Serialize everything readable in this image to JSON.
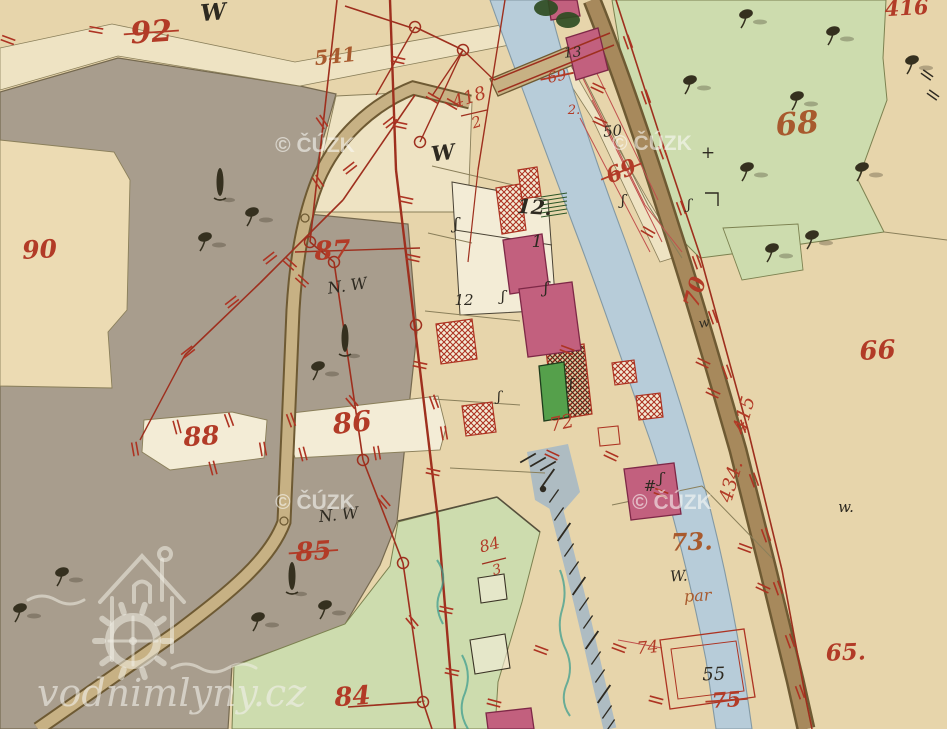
{
  "map_meta": {
    "kind": "historical-cadastral-map",
    "width": 947,
    "height": 729
  },
  "palette": {
    "paper": "#e7d5ab",
    "paper_light": "#eee3c3",
    "paper_white": "#f3ecd6",
    "pasture_gray": "#a89d8d",
    "pasture_edge": "#75694f",
    "meadow_green": "#cddcae",
    "meadow_edge": "#7c8150",
    "river_blue": "#b7ccd9",
    "river_edge": "#8399a4",
    "race_blue": "#aebcc2",
    "road_tan": "#c7b184",
    "road_brown": "#a7895c",
    "road_edge": "#6e5a33",
    "boundary_olive": "#8a7f5a",
    "boundary_dark": "#56503c",
    "building_pink": "#c2607e",
    "building_pink_edge": "#7e2847",
    "building_green": "#55a04b",
    "building_green_edge": "#1e3d1c",
    "hatch_red": "#ad3322",
    "survey_red": "#9e2f1e",
    "number_red": "#b23b27",
    "number_brown": "#a85a2e",
    "ink_black": "#2e2a21",
    "tree_black": "#35301f",
    "pencil_teal": "#3f9e8f",
    "watermark": "rgba(250,249,246,0.58)"
  },
  "watermarks": {
    "cuzk": {
      "text": "© ČÚZK",
      "positions": [
        [
          315,
          152
        ],
        [
          652,
          150
        ],
        [
          315,
          509
        ],
        [
          672,
          509
        ]
      ]
    },
    "logo": {
      "text": "vodnimlyny.cz"
    }
  },
  "labels": [
    {
      "t": "92",
      "x": 152,
      "y": 42,
      "s": 30,
      "c": "number_red",
      "r": -4,
      "k": true
    },
    {
      "t": "W",
      "x": 214,
      "y": 20,
      "s": 23,
      "c": "ink_black",
      "r": -5,
      "k": false
    },
    {
      "t": "90",
      "x": 40,
      "y": 258,
      "s": 25,
      "c": "number_red",
      "r": -3,
      "k": false
    },
    {
      "t": "541",
      "x": 336,
      "y": 63,
      "s": 20,
      "c": "number_brown",
      "r": -6,
      "k": false
    },
    {
      "t": "418",
      "x": 471,
      "y": 103,
      "s": 18,
      "c": "number_red",
      "r": -18,
      "k": false
    },
    {
      "t": "2",
      "x": 478,
      "y": 127,
      "s": 15,
      "c": "number_red",
      "r": -18,
      "k": false
    },
    {
      "t": "W",
      "x": 444,
      "y": 160,
      "s": 21,
      "c": "ink_black",
      "r": -8,
      "k": false
    },
    {
      "t": "87",
      "x": 333,
      "y": 259,
      "s": 26,
      "c": "number_red",
      "r": -3,
      "k": false
    },
    {
      "t": "N. W",
      "x": 348,
      "y": 291,
      "s": 16,
      "c": "ink_black",
      "r": -8,
      "k": false
    },
    {
      "t": "12.",
      "x": 534,
      "y": 214,
      "s": 20,
      "c": "ink_black",
      "r": 4,
      "k": false
    },
    {
      "t": "1",
      "x": 537,
      "y": 247,
      "s": 17,
      "c": "ink_black",
      "r": 0,
      "k": false
    },
    {
      "t": "12",
      "x": 464,
      "y": 305,
      "s": 15,
      "c": "ink_black",
      "r": 0,
      "k": false
    },
    {
      "t": "69",
      "x": 558,
      "y": 81,
      "s": 15,
      "c": "number_red",
      "r": -12,
      "k": true
    },
    {
      "t": "2.",
      "x": 574,
      "y": 114,
      "s": 13,
      "c": "number_red",
      "r": 0,
      "k": false
    },
    {
      "t": "13",
      "x": 573,
      "y": 57,
      "s": 14,
      "c": "ink_black",
      "r": -5,
      "k": false
    },
    {
      "t": "69",
      "x": 624,
      "y": 178,
      "s": 22,
      "c": "number_red",
      "r": -22,
      "k": true
    },
    {
      "t": "50",
      "x": 613,
      "y": 136,
      "s": 15,
      "c": "ink_black",
      "r": -5,
      "k": false
    },
    {
      "t": "70",
      "x": 702,
      "y": 294,
      "s": 22,
      "c": "number_red",
      "r": -74,
      "k": false
    },
    {
      "t": "68",
      "x": 798,
      "y": 134,
      "s": 31,
      "c": "number_brown",
      "r": -5,
      "k": false
    },
    {
      "t": "416",
      "x": 907,
      "y": 15,
      "s": 21,
      "c": "number_red",
      "r": -3,
      "k": false
    },
    {
      "t": "66",
      "x": 878,
      "y": 359,
      "s": 26,
      "c": "number_red",
      "r": -3,
      "k": false
    },
    {
      "t": "415",
      "x": 750,
      "y": 416,
      "s": 19,
      "c": "number_red",
      "r": -74,
      "k": false
    },
    {
      "t": "434.",
      "x": 737,
      "y": 483,
      "s": 19,
      "c": "number_red",
      "r": -74,
      "k": false
    },
    {
      "t": "w.",
      "x": 846,
      "y": 512,
      "s": 15,
      "c": "ink_black",
      "r": 0,
      "k": false
    },
    {
      "t": "w",
      "x": 705,
      "y": 327,
      "s": 13,
      "c": "ink_black",
      "r": -12,
      "k": false
    },
    {
      "t": "88",
      "x": 202,
      "y": 445,
      "s": 26,
      "c": "number_red",
      "r": -4,
      "k": false
    },
    {
      "t": "86",
      "x": 353,
      "y": 432,
      "s": 28,
      "c": "number_red",
      "r": -6,
      "k": false
    },
    {
      "t": "N. W",
      "x": 339,
      "y": 520,
      "s": 16,
      "c": "ink_black",
      "r": -6,
      "k": false
    },
    {
      "t": "85",
      "x": 314,
      "y": 560,
      "s": 26,
      "c": "number_red",
      "r": -4,
      "k": true
    },
    {
      "t": "84",
      "x": 491,
      "y": 550,
      "s": 16,
      "c": "number_red",
      "r": -15,
      "k": false
    },
    {
      "t": "3",
      "x": 498,
      "y": 574,
      "s": 14,
      "c": "number_red",
      "r": -15,
      "k": false
    },
    {
      "t": "72",
      "x": 563,
      "y": 429,
      "s": 19,
      "c": "number_red",
      "r": -12,
      "k": false
    },
    {
      "t": "73.",
      "x": 692,
      "y": 550,
      "s": 24,
      "c": "number_brown",
      "r": -2,
      "k": false
    },
    {
      "t": "W.",
      "x": 679,
      "y": 581,
      "s": 15,
      "c": "ink_black",
      "r": -3,
      "k": false
    },
    {
      "t": "par",
      "x": 698,
      "y": 601,
      "s": 16,
      "c": "number_brown",
      "r": -3,
      "k": false
    },
    {
      "t": "74",
      "x": 648,
      "y": 653,
      "s": 17,
      "c": "number_red",
      "r": -5,
      "k": false
    },
    {
      "t": "55",
      "x": 714,
      "y": 680,
      "s": 18,
      "c": "ink_black",
      "r": -2,
      "k": false
    },
    {
      "t": "75",
      "x": 727,
      "y": 707,
      "s": 21,
      "c": "number_red",
      "r": -4,
      "k": true
    },
    {
      "t": "65.",
      "x": 846,
      "y": 660,
      "s": 23,
      "c": "number_red",
      "r": -2,
      "k": false
    },
    {
      "t": "84",
      "x": 353,
      "y": 705,
      "s": 26,
      "c": "number_red",
      "r": -4,
      "k": false
    },
    {
      "t": "+",
      "x": 708,
      "y": 158,
      "s": 17,
      "c": "ink_black",
      "r": 0,
      "k": false
    },
    {
      "t": "#",
      "x": 650,
      "y": 491,
      "s": 15,
      "c": "ink_black",
      "r": 0,
      "k": false
    },
    {
      "t": "ʃ",
      "x": 456,
      "y": 229,
      "s": 16,
      "c": "ink_black",
      "r": 0,
      "k": false
    },
    {
      "t": "ʃ",
      "x": 503,
      "y": 301,
      "s": 15,
      "c": "ink_black",
      "r": 0,
      "k": false
    },
    {
      "t": "ʃ",
      "x": 546,
      "y": 293,
      "s": 16,
      "c": "ink_black",
      "r": 0,
      "k": false
    },
    {
      "t": "ʃ",
      "x": 623,
      "y": 205,
      "s": 15,
      "c": "ink_black",
      "r": 0,
      "k": false
    },
    {
      "t": "ʃ",
      "x": 689,
      "y": 209,
      "s": 14,
      "c": "ink_black",
      "r": 0,
      "k": false
    },
    {
      "t": "ʃ",
      "x": 571,
      "y": 389,
      "s": 15,
      "c": "ink_black",
      "r": 0,
      "k": false
    },
    {
      "t": "ʃ",
      "x": 661,
      "y": 483,
      "s": 15,
      "c": "ink_black",
      "r": 0,
      "k": false
    },
    {
      "t": "ʃ",
      "x": 499,
      "y": 401,
      "s": 14,
      "c": "ink_black",
      "r": 0,
      "k": false
    }
  ]
}
